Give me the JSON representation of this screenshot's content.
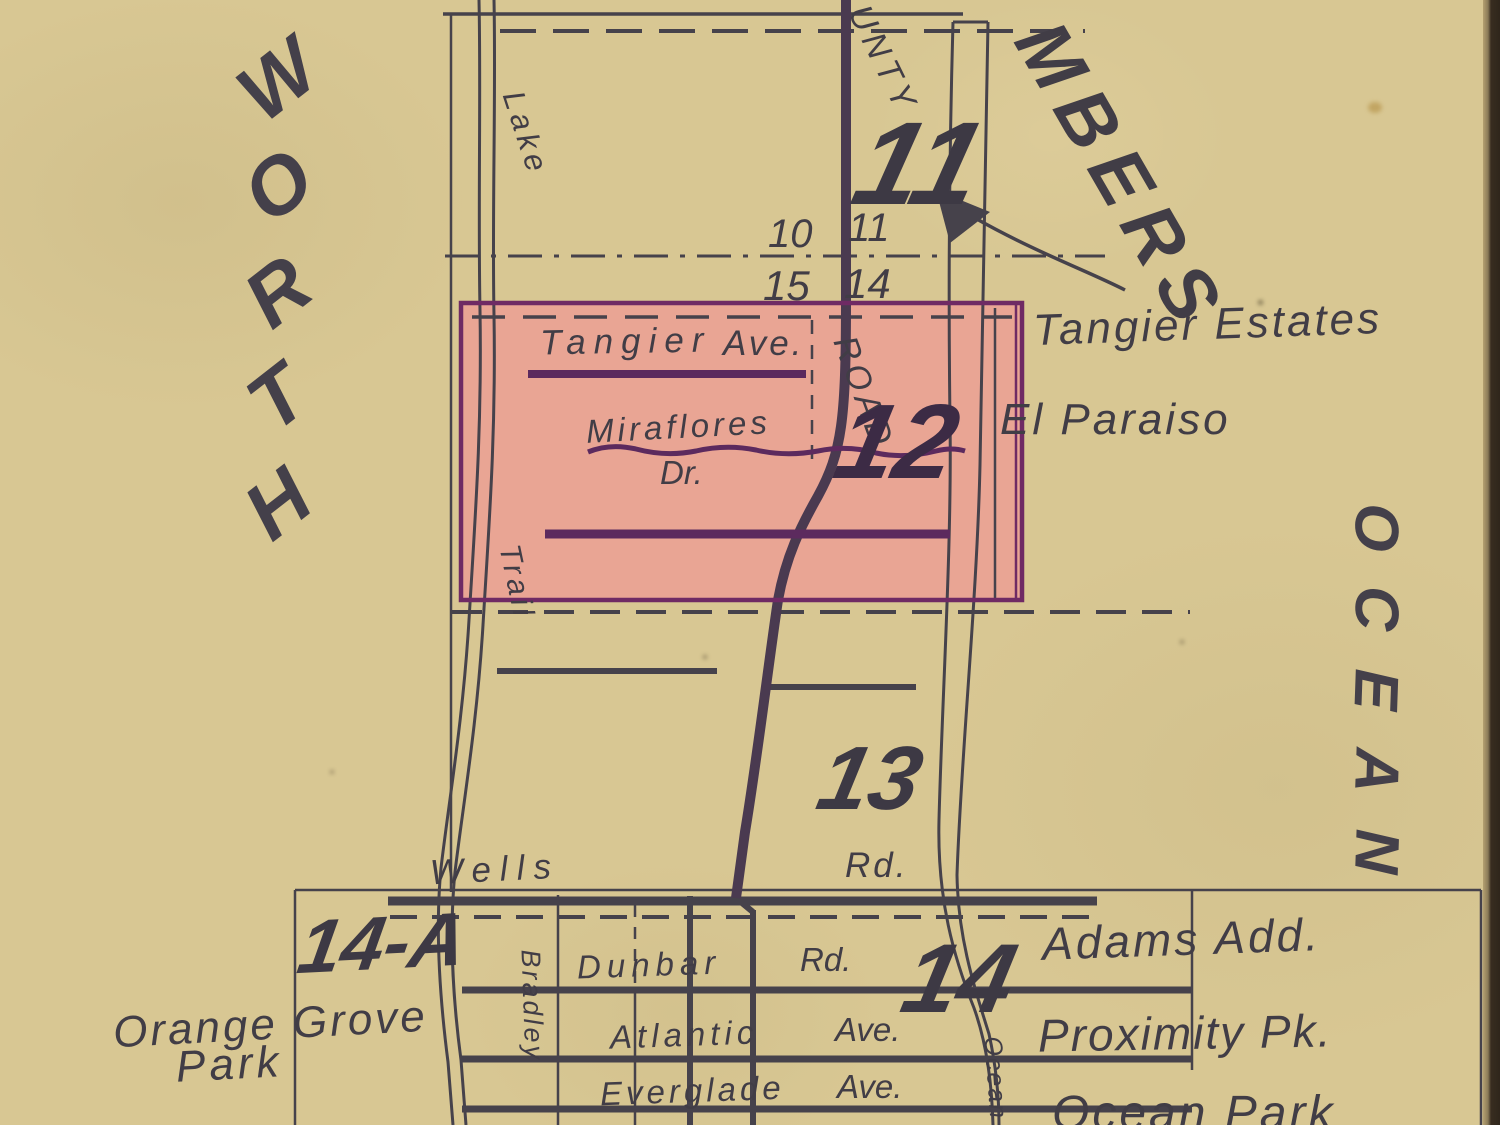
{
  "map": {
    "margin_words": {
      "left_vertical": "WORTH",
      "right_vertical": "OCEAN",
      "top_right_diagonal": "MBERS"
    },
    "sections": {
      "s11_big": "11",
      "s12_big": "12",
      "s13_big": "13",
      "s14_big": "14",
      "s14a_big": "14-A",
      "corner_nw": "10",
      "corner_ne": "11",
      "corner_sw": "15",
      "corner_se": "14"
    },
    "roads": {
      "county_vertical": "UNTY",
      "road_vertical": "ROAD",
      "lake_vertical": "Lake",
      "trail_vertical": "Trail",
      "bradley_vertical": "Bradley",
      "ocean_small_vertical": "Ocean",
      "tangier": "Tangier",
      "tangier_suffix": "Ave.",
      "miraflores": "Miraflores",
      "miraflores_suffix": "Dr.",
      "wells": "Wells",
      "wells_suffix": "Rd.",
      "dunbar": "Dunbar",
      "dunbar_suffix": "Rd.",
      "atlantic": "Atlantic",
      "atlantic_suffix": "Ave.",
      "everglade": "Everglade",
      "everglade_suffix": "Ave."
    },
    "places": {
      "tangier_estates": "Tangier Estates",
      "el_paraiso": "El Paraiso",
      "adams_add": "Adams Add.",
      "proximity_pk": "Proximity Pk.",
      "ocean_park": "Ocean Park",
      "orange_grove_line1": "Orange Grove",
      "orange_grove_line2": "Park"
    },
    "colors": {
      "paper": "#d8c793",
      "ink": "#46424b",
      "highlight_fill": "#eaa294",
      "highlight_border": "#6f2a64",
      "purple_road": "#5c2a5e",
      "edge_strip": "#382d20"
    }
  }
}
